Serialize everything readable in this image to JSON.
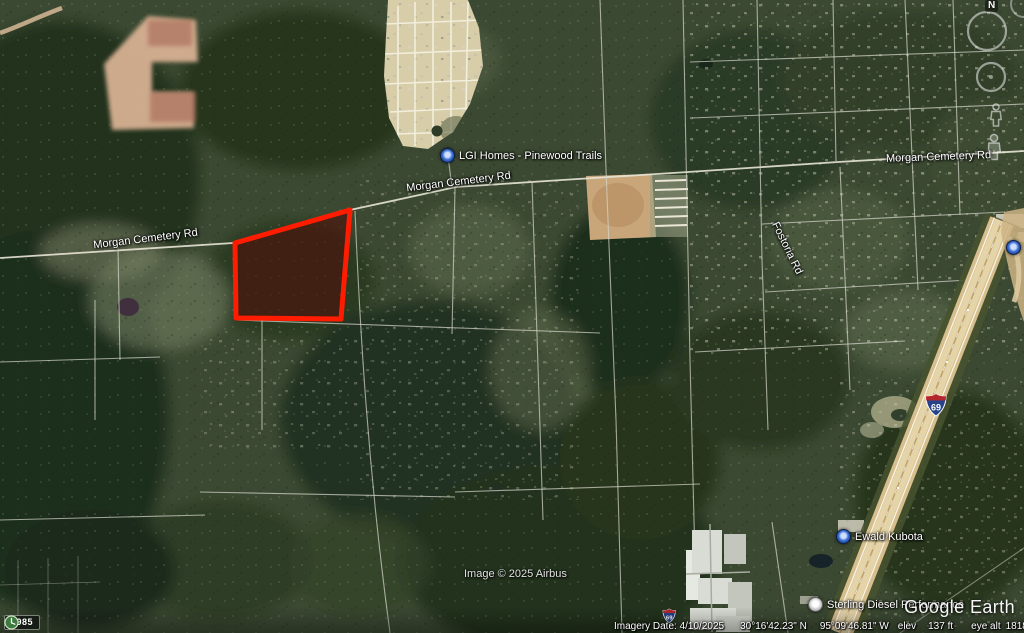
{
  "map_labels": {
    "road_main": "Morgan Cemetery Rd",
    "road_fostoria": "Fostoria Rd",
    "placemark_lgi": "LGI Homes - Pinewood Trails",
    "placemark_kubota": "Ewald Kubota",
    "placemark_sterling": "Sterling Diesel Performance",
    "highway_shield": "69"
  },
  "overlay": {
    "parcel_outline_color": "#ff1c00",
    "parcel_fill_color": "#4c100a"
  },
  "controls": {
    "compass_north": "N",
    "history_year": "1985"
  },
  "watermark": {
    "logo": "Google Earth",
    "attribution": "Image © 2025 Airbus"
  },
  "status_bar": {
    "imagery_date": "Imagery Date: 4/10/2025",
    "latitude": "30°16'42.23\" N",
    "longitude": "95°09'46.81\" W",
    "elev_label": "elev",
    "elevation": "137 ft",
    "eye_alt_label": "eye alt",
    "eye_altitude": "18180 ft"
  }
}
